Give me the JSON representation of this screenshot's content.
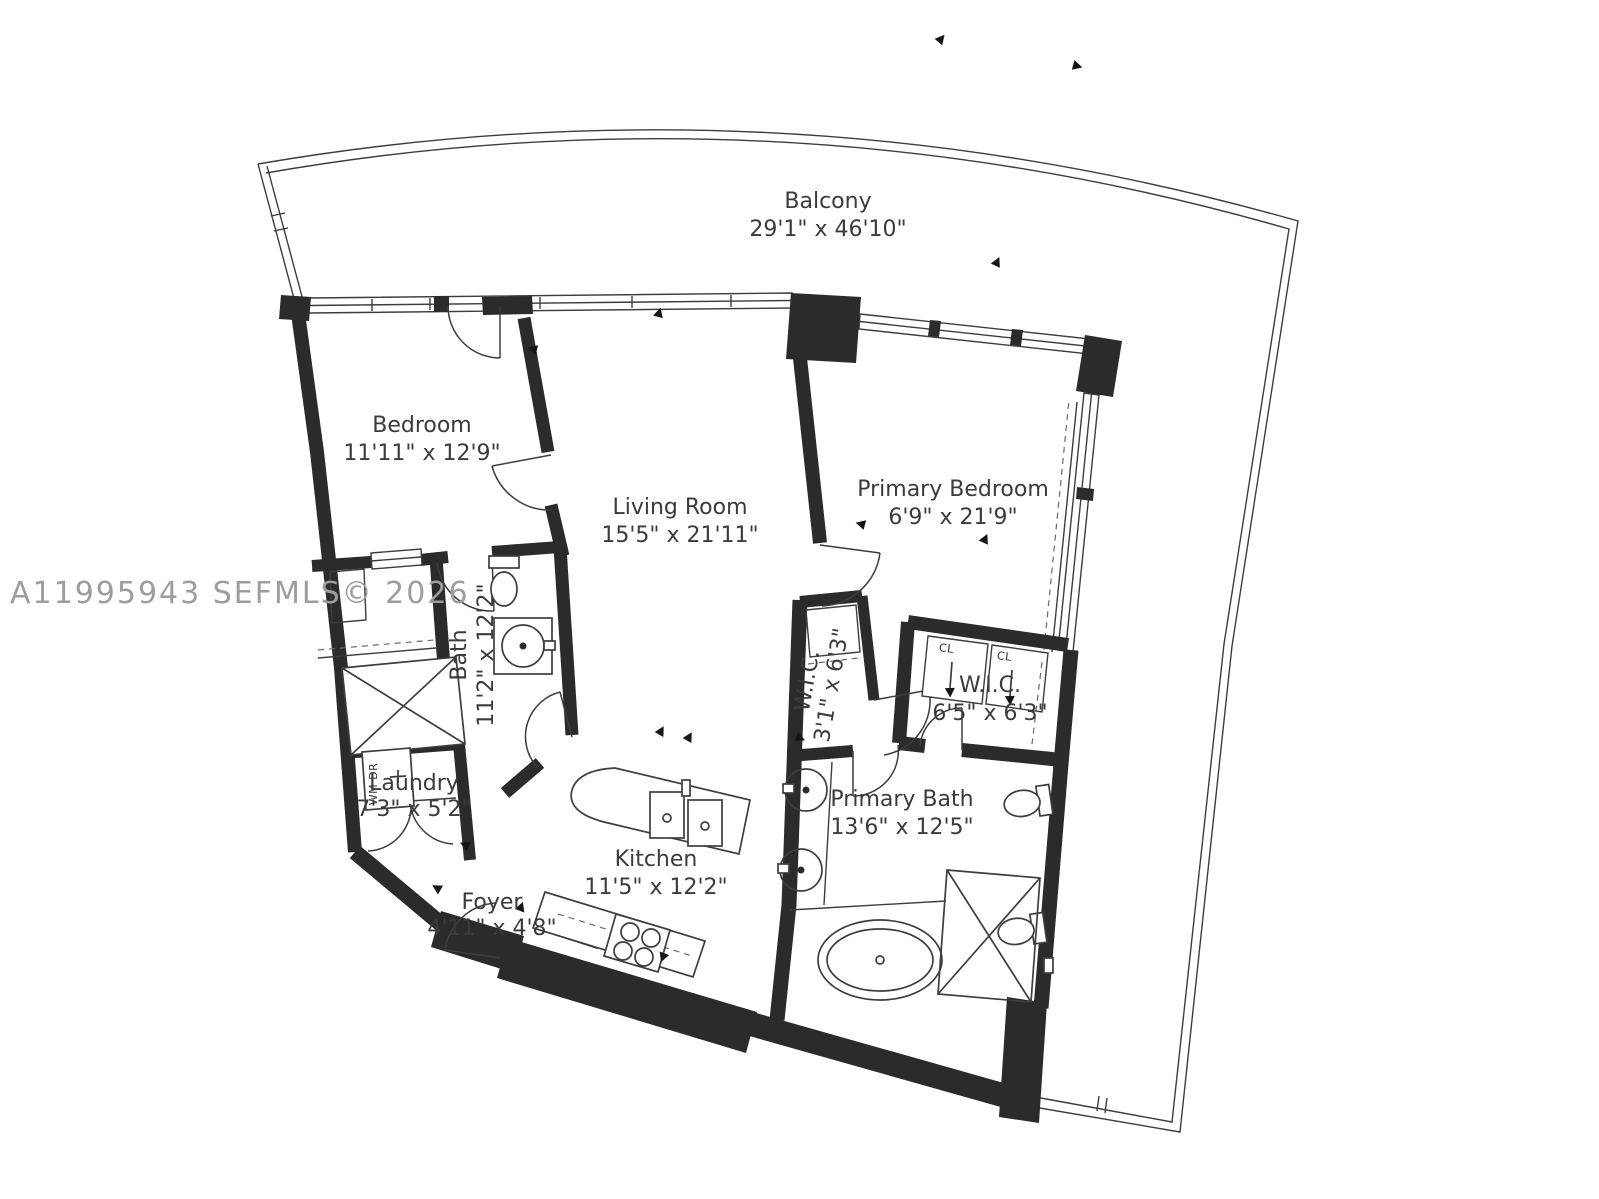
{
  "title": "Apartment floor plan",
  "watermark": "A11995943  SEFMLS© 2026",
  "colors": {
    "background": "#ffffff",
    "wall": "#2b2b2b",
    "line": "#3d3d3d",
    "label": "#3b3b3b",
    "watermark": "#9d9d9d"
  },
  "rooms": [
    {
      "id": "balcony",
      "name": "Balcony",
      "dims": "29'1\" x 46'10\"",
      "x": 828,
      "y": 208,
      "rotate": 0,
      "gap": 28
    },
    {
      "id": "bedroom",
      "name": "Bedroom",
      "dims": "11'11\" x 12'9\"",
      "x": 422,
      "y": 432,
      "rotate": 0,
      "gap": 28
    },
    {
      "id": "living-room",
      "name": "Living Room",
      "dims": "15'5\" x 21'11\"",
      "x": 680,
      "y": 514,
      "rotate": 0,
      "gap": 28
    },
    {
      "id": "primary-bedroom",
      "name": "Primary Bedroom",
      "dims": "6'9\" x 21'9\"",
      "x": 953,
      "y": 496,
      "rotate": 0,
      "gap": 28
    },
    {
      "id": "bath",
      "name": "Bath",
      "dims": "11'2\" x 12'2\"",
      "x": 466,
      "y": 655,
      "rotate": -90,
      "gap": 27
    },
    {
      "id": "wic-1",
      "name": "W.I.C.",
      "dims": "3'1\" x 6'3\"",
      "x": 814,
      "y": 682,
      "rotate": -80,
      "gap": 25
    },
    {
      "id": "wic-2",
      "name": "W.I.C.",
      "dims": "6'5\" x 6'3\"",
      "x": 990,
      "y": 692,
      "rotate": 0,
      "gap": 28
    },
    {
      "id": "laundry",
      "name": "Laundry",
      "dims": "7'3\" x 5'2\"",
      "x": 414,
      "y": 790,
      "rotate": 0,
      "gap": 26
    },
    {
      "id": "primary-bath",
      "name": "Primary Bath",
      "dims": "13'6\" x 12'5\"",
      "x": 902,
      "y": 806,
      "rotate": 0,
      "gap": 28
    },
    {
      "id": "kitchen",
      "name": "Kitchen",
      "dims": "11'5\" x 12'2\"",
      "x": 656,
      "y": 866,
      "rotate": 0,
      "gap": 28
    },
    {
      "id": "foyer",
      "name": "Foyer",
      "dims": "4'11\" x 4'8\"",
      "x": 492,
      "y": 909,
      "rotate": 0,
      "gap": 26
    }
  ],
  "fixture_labels": {
    "washer_dryer": "WM DR",
    "closet_left": "CL",
    "closet_right": "CL"
  }
}
